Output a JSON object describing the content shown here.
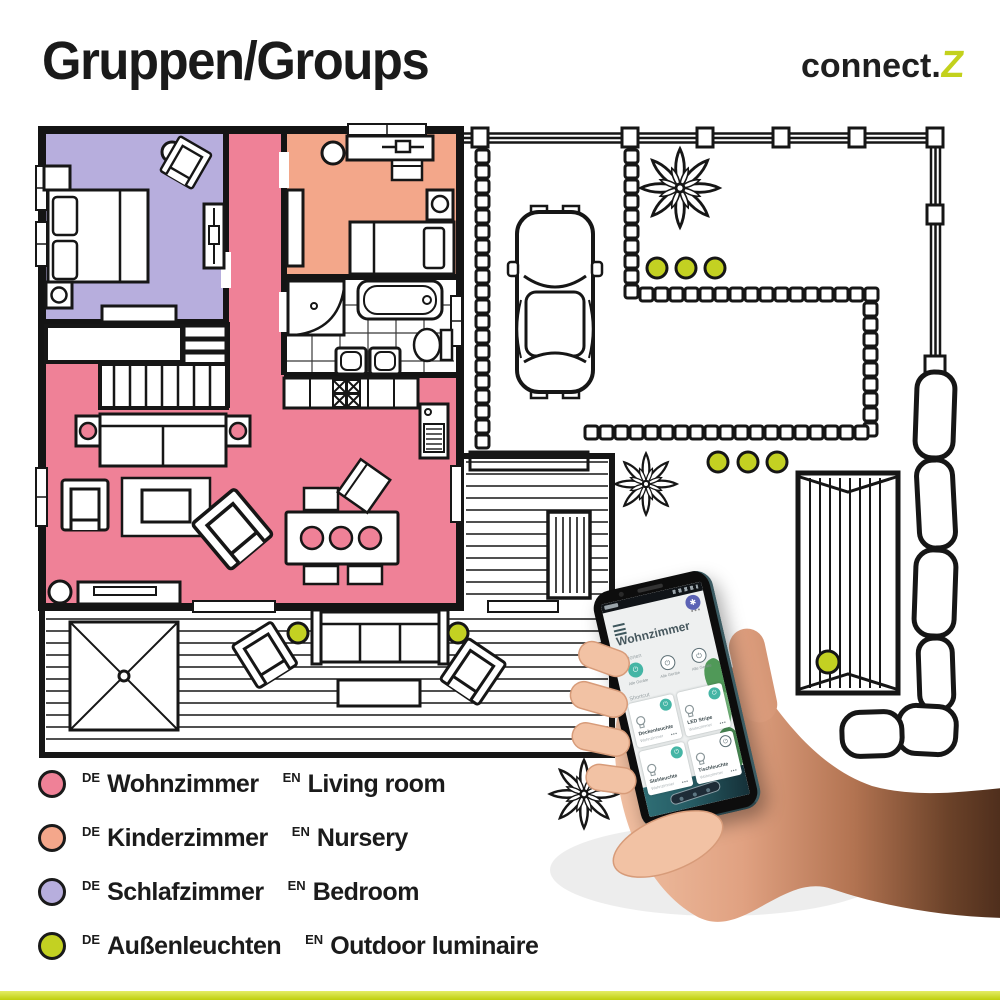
{
  "header": {
    "title": "Gruppen/Groups",
    "brand": {
      "name": "connect.",
      "accent": "Z"
    }
  },
  "legend": {
    "items": [
      {
        "tag_de": "DE",
        "name_de": "Wohnzimmer",
        "tag_en": "EN",
        "name_en": "Living room",
        "color": "#ef8197"
      },
      {
        "tag_de": "DE",
        "name_de": "Kinderzimmer",
        "tag_en": "EN",
        "name_en": "Nursery",
        "color": "#f4a78b"
      },
      {
        "tag_de": "DE",
        "name_de": "Schlafzimmer",
        "tag_en": "EN",
        "name_en": "Bedroom",
        "color": "#b7aedd"
      },
      {
        "tag_de": "DE",
        "name_de": "Außenleuchten",
        "tag_en": "EN",
        "name_en": "Outdoor luminaire",
        "color": "#c3d122"
      }
    ]
  },
  "floorplan": {
    "rooms": [
      {
        "name": "living-room",
        "color": "#ef8197"
      },
      {
        "name": "nursery",
        "color": "#f3a78a"
      },
      {
        "name": "bedroom",
        "color": "#b7aedd"
      }
    ],
    "outdoor_light_color": "#c3d122",
    "line_color": "#161616"
  },
  "phone": {
    "accent_color": "#45b5a5",
    "app": {
      "title": "Wohnzimmer",
      "more_icon": "•••",
      "fab_icon": "✱",
      "sections": {
        "actions": "Aktionen",
        "shortcuts": "Shortcut"
      },
      "action_buttons": [
        {
          "label": "Alle Geräte",
          "state": "on"
        },
        {
          "label": "Alle Geräte",
          "state": "off"
        },
        {
          "label": "Alle Geräte",
          "state": "off"
        }
      ],
      "cards": [
        {
          "name": "Deckenleuchte",
          "room": "Wohnzimmer",
          "state": "on",
          "more": "•••"
        },
        {
          "name": "LED Stripe",
          "room": "Wohnzimmer",
          "state": "on",
          "more": "•••"
        },
        {
          "name": "Stehleuchte",
          "room": "Wohnzimmer",
          "state": "on",
          "more": "•••"
        },
        {
          "name": "Tischleuchte",
          "room": "Wohnzimmer",
          "state": "off",
          "more": "•••"
        }
      ]
    }
  },
  "footer": {
    "bar_color": "#c3d122"
  }
}
